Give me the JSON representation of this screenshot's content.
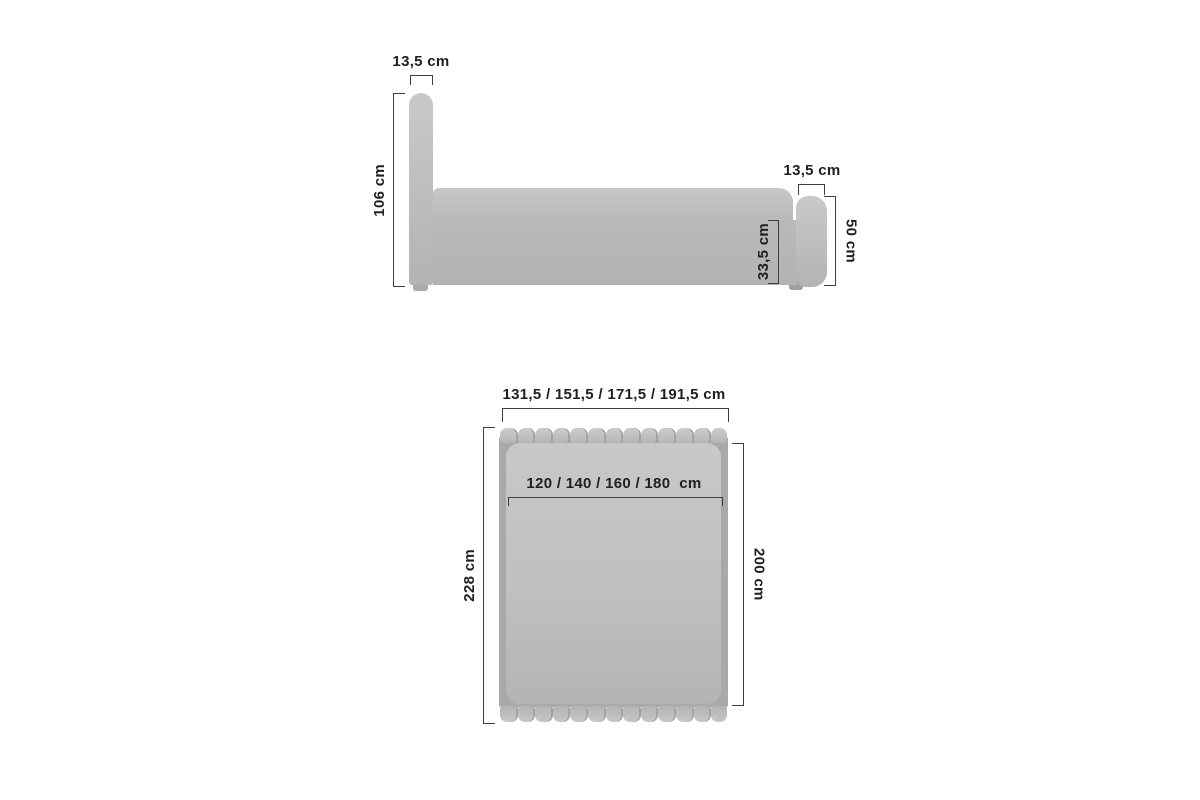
{
  "title": "Bed dimensions diagram",
  "colors": {
    "background": "#ffffff",
    "line": "#3f3f3f",
    "text": "#202020",
    "fabric_light": "#c9cacc",
    "fabric_mid": "#b7b8ba",
    "fabric_dark": "#a8a9ab"
  },
  "side_view": {
    "headboard_thickness_label": "13,5 cm",
    "headboard_height_label": "106 cm",
    "footboard_thickness_label": "13,5 cm",
    "footboard_height_label": "50 cm",
    "frame_height_label": "33,5 cm"
  },
  "top_view": {
    "overall_width_label": "131,5 / 151,5 / 171,5 / 191,5 cm",
    "mattress_width_label": "120 / 140 / 160 / 180  cm",
    "overall_length_label": "228 cm",
    "mattress_length_label": "200 cm",
    "band_segments": 13
  }
}
